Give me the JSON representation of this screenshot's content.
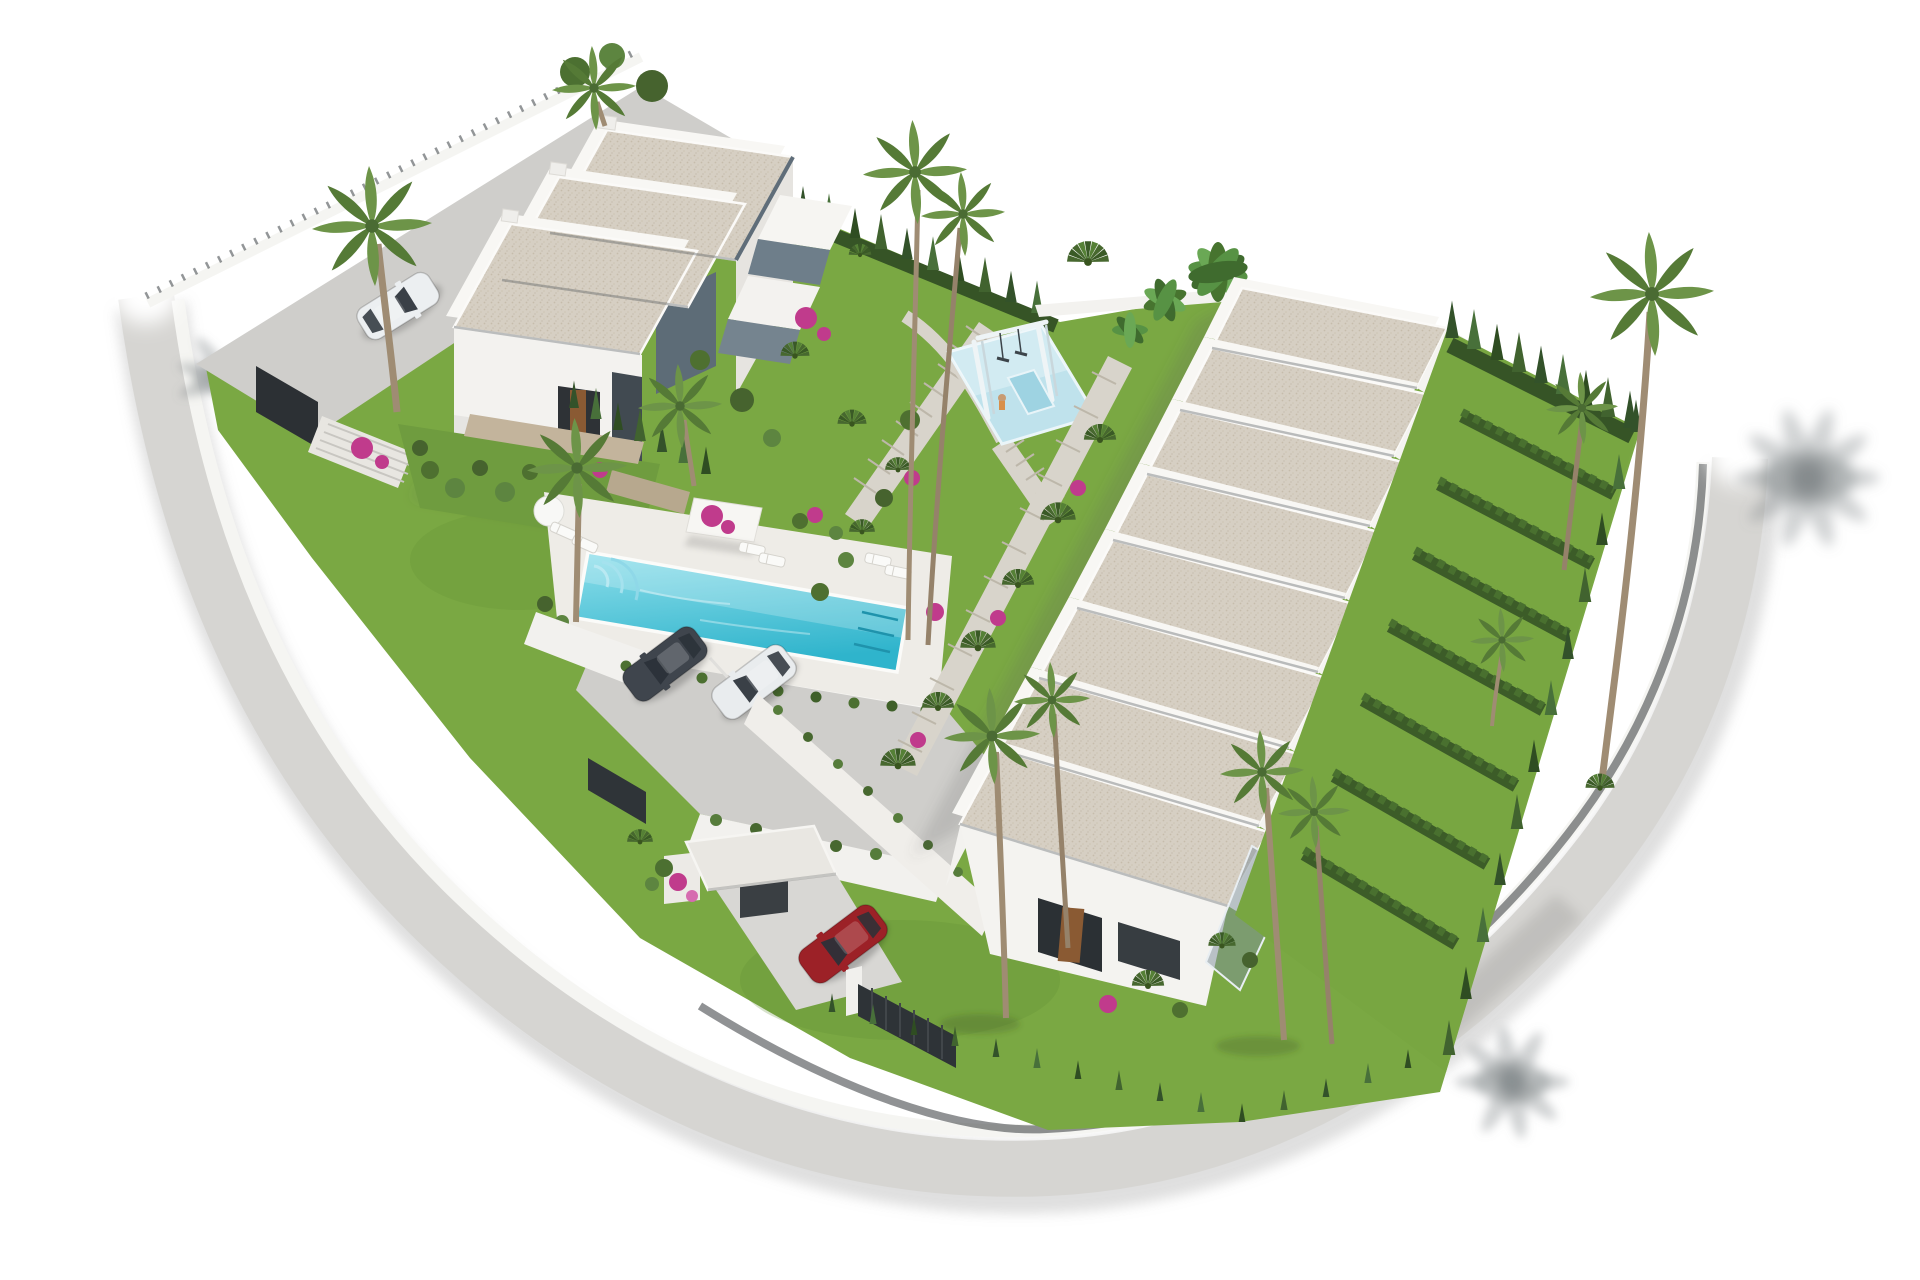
{
  "scene": {
    "type": "architectural-3d-render",
    "subject": "aerial render of a white residential complex with communal pool and gardens",
    "background": "#ffffff",
    "palette": {
      "roof_beige": "#d6cfc3",
      "roof_speckle": "#c6bcab",
      "wall_white": "#f3f2ef",
      "wall_shade": "#e2e0dc",
      "parapet": "#f8f7f4",
      "trim_steel": "#5f6d79",
      "glass": "#64747f",
      "road": "#d6d5d2",
      "sidewalk": "#f5f5f2",
      "pavement": "#cfcecb",
      "path_stone": "#d8d4cb",
      "stone_wall": "#c3b49c",
      "grass": "#7aa843",
      "grass_gardens": "#78a641",
      "hedge": "#3c5c28",
      "cypress_dark": "#33522a",
      "cypress_light": "#48703a",
      "palm_trunk": "#9f8c73",
      "pool_light": "#8fdfeb",
      "pool_deep": "#2fb4cc",
      "pool_lane": "#1f93ac",
      "playground_blue": "#bfe2ec",
      "bougainvillea": "#c03b8c",
      "fence": "#34393d",
      "gate": "#2e3337",
      "terrace_gray": "#98a1a9",
      "car_dark": "#3f454d",
      "car_white": "#e9ecee",
      "car_red": "#9c2127"
    },
    "buildings": {
      "villa_block": {
        "label": "two-storey villa block",
        "roof_sections": 3,
        "balcony_levels": 2
      },
      "townhouse_row": {
        "label": "terraced townhouse row",
        "units": 8,
        "private_gardens": 8
      }
    },
    "amenities": {
      "pool": {
        "shape": "rectangular",
        "loungers": 6,
        "parasols": 1,
        "shade_structures": 2
      },
      "playground": {
        "swing_set": 1,
        "slide": 1
      },
      "parking": {
        "cars_parked": 2
      }
    },
    "vehicles": [
      {
        "id": "car-dark",
        "color_hex": "#3f454d",
        "location": "parking"
      },
      {
        "id": "car-white",
        "color_hex": "#e9ecee",
        "location": "parking"
      },
      {
        "id": "car-white-2",
        "color_hex": "#eceff1",
        "location": "driveway"
      },
      {
        "id": "car-red",
        "color_hex": "#9c2127",
        "location": "entrance-gate"
      }
    ],
    "vegetation": {
      "palm_trees": 13,
      "cypress_hedges": true,
      "banana_plants": true,
      "bougainvillea": true
    },
    "infrastructure": {
      "perimeter_road": true,
      "boundary_wall": true,
      "metal_fence": true,
      "entrance_gatehouse": true,
      "sliding_gate": true,
      "stairs": 2
    }
  }
}
